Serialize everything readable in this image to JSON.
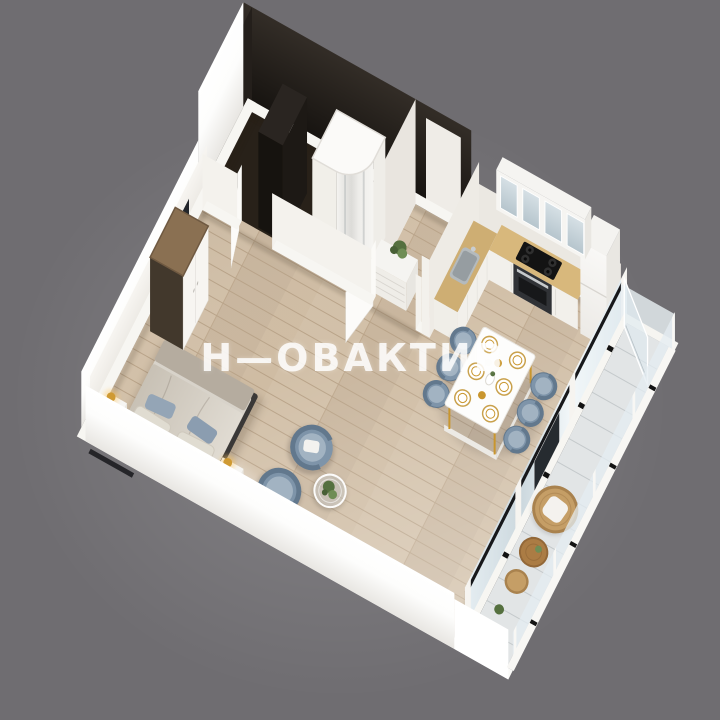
{
  "watermark": {
    "text": "Н—ОВАКТИВ",
    "color": "#ffffff",
    "opacity": 0.87
  },
  "background_color": "#6f6d71",
  "palette": {
    "wall_top": "#f7f6f2",
    "wall_outer_bright": "#ffffff",
    "wall_inner_white": "#f1eeea",
    "dark_wall": "#221d19",
    "dark_wall_light": "#332d27",
    "dark_floor": "#282119",
    "wood_floor": "#cfbca3",
    "wood_floor_line": "#8a6a4a",
    "counter_wood": "#d8b87c",
    "cabinet_white": "#f2f0eb",
    "glass_light": "#dfe9ee",
    "glass_pane": "#b6c5cd",
    "window_black": "#17181b",
    "chair_blue": "#7e94a9",
    "chair_blue_light": "#a2b3c2",
    "chair_blue_dark": "#62788d",
    "bed_linen": "#d8d3ca",
    "bed_frame_dark": "#3a3837",
    "pillow_beige": "#e0dcd1",
    "pillow_blue": "#94a5b6",
    "gold": "#cf9a33",
    "gold_deep": "#c9962e",
    "rattan": "#c59e66",
    "rattan_dark": "#a9824e",
    "balcony_table_wood": "#ab7c44",
    "balcony_floor": "#e2e5e6",
    "plant_green": "#55703f",
    "plant_green_light": "#6f8d55",
    "steel": "#b4babd",
    "wardrobe_wood": "#8a7052",
    "wardrobe_side_dark": "#42382c",
    "cooktop_black": "#131313",
    "oven_front": "#303236",
    "clip_black": "#141414"
  },
  "scene": {
    "type": "axonometric-floor-plan-render",
    "rooms": [
      "bathroom",
      "hallway",
      "kitchen",
      "living-bedroom",
      "balcony"
    ],
    "counts": {
      "dining_chairs": 6,
      "plates": 6,
      "armchairs": 2,
      "nightstands": 2,
      "gold_bowls": 2
    },
    "objects": [
      "shower-cabin",
      "bathroom-column",
      "vanity-unit",
      "hall-dresser",
      "plant",
      "entrance-door",
      "door-leaf",
      "kitchen-counter",
      "sink",
      "cooktop",
      "oven",
      "fridge",
      "upper-cabinets",
      "dining-table",
      "dining-chair",
      "plate",
      "double-bed",
      "pillows",
      "nightstand",
      "table-lamp",
      "wardrobe",
      "armchair",
      "glass-coffee-table",
      "balcony-glazing",
      "open-window-sash",
      "glass-balustrade",
      "papasan-chair",
      "balcony-table",
      "rattan-pouf"
    ]
  }
}
